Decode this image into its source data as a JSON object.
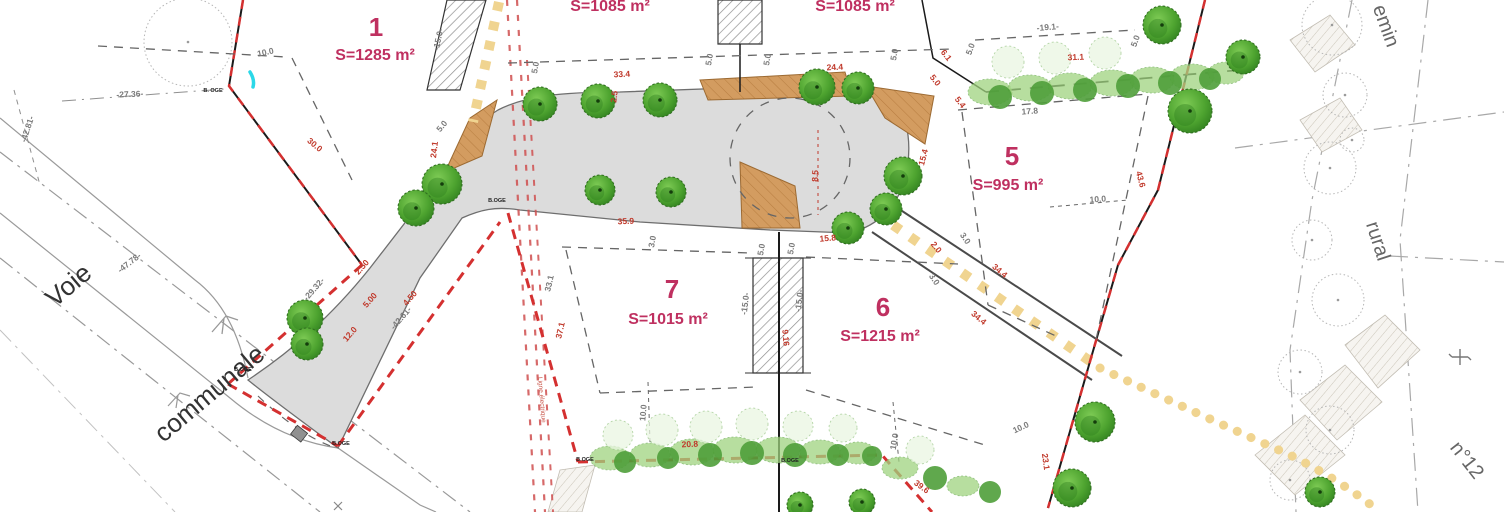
{
  "lots": {
    "lot1": {
      "num": "1",
      "area": "S=1285 m²"
    },
    "lot_top_left": {
      "area": "S=1085 m²"
    },
    "lot_top_right": {
      "area": "S=1085 m²"
    },
    "lot5": {
      "num": "5",
      "area": "S=995 m²"
    },
    "lot6": {
      "num": "6",
      "area": "S=1215 m²"
    },
    "lot7": {
      "num": "7",
      "area": "S=1015 m²"
    }
  },
  "roads": {
    "voie": "Voie",
    "communale": "communale",
    "chemin_partial": "emin",
    "rural": "rural",
    "numero": "n°12"
  },
  "easement_label": "Ligne électrique",
  "colors": {
    "lot_label": "#bf3060",
    "dim_red": "#c0392b",
    "dim_gray": "#7a7a7a",
    "boundary_red": "#d43030",
    "road_fill": "#dcdcdc",
    "island_brown": "#d39c60",
    "hedge_green": "#9fd37f",
    "tree_green": "#4da32f",
    "path_yellow": "#f0d490"
  },
  "map": {
    "survey_marks": [
      {
        "t": "B. OGE",
        "x": 213,
        "y": 92
      },
      {
        "t": "B.OGE",
        "x": 497,
        "y": 202
      },
      {
        "t": "B.OGE",
        "x": 243,
        "y": 371
      },
      {
        "t": "B.OGE",
        "x": 341,
        "y": 445
      },
      {
        "t": "B.OGE",
        "x": 585,
        "y": 461
      },
      {
        "t": "B.OGE",
        "x": 790,
        "y": 462
      }
    ],
    "dim_labels": [
      {
        "t": "-27.36-",
        "x": 130,
        "y": 97,
        "r": -3,
        "c": "g"
      },
      {
        "t": "-47.78-",
        "x": 131,
        "y": 265,
        "r": -38,
        "c": "g"
      },
      {
        "t": "-42.81-",
        "x": 30,
        "y": 130,
        "r": -72,
        "c": "g"
      },
      {
        "t": "-29.32-",
        "x": 316,
        "y": 291,
        "r": -49,
        "c": "g"
      },
      {
        "t": "-42.61-",
        "x": 403,
        "y": 320,
        "r": -49,
        "c": "g"
      },
      {
        "t": "-19.1-",
        "x": 1048,
        "y": 30,
        "r": -5,
        "c": "g"
      },
      {
        "t": "17.8",
        "x": 1030,
        "y": 114,
        "r": -4,
        "c": "g"
      },
      {
        "t": "10.0",
        "x": 266,
        "y": 55,
        "r": -12,
        "c": "g"
      },
      {
        "t": "10.0",
        "x": 1098,
        "y": 202,
        "r": -4,
        "c": "g"
      },
      {
        "t": "10.0",
        "x": 646,
        "y": 413,
        "r": -85,
        "c": "g"
      },
      {
        "t": "10.0",
        "x": 897,
        "y": 442,
        "r": -80,
        "c": "g"
      },
      {
        "t": "10.0",
        "x": 1022,
        "y": 430,
        "r": -25,
        "c": "g"
      },
      {
        "t": "5.0",
        "x": 538,
        "y": 68,
        "r": -80,
        "c": "g"
      },
      {
        "t": "5.0",
        "x": 712,
        "y": 60,
        "r": -80,
        "c": "g"
      },
      {
        "t": "5.0",
        "x": 770,
        "y": 60,
        "r": -80,
        "c": "g"
      },
      {
        "t": "5.0",
        "x": 897,
        "y": 55,
        "r": -80,
        "c": "g"
      },
      {
        "t": "5.0",
        "x": 973,
        "y": 50,
        "r": -70,
        "c": "g"
      },
      {
        "t": "5.0",
        "x": 1138,
        "y": 42,
        "r": -70,
        "c": "g"
      },
      {
        "t": "5.0",
        "x": 444,
        "y": 128,
        "r": -50,
        "c": "g"
      },
      {
        "t": "3.0",
        "x": 655,
        "y": 242,
        "r": -80,
        "c": "g"
      },
      {
        "t": "5.0",
        "x": 764,
        "y": 250,
        "r": -80,
        "c": "g"
      },
      {
        "t": "5.0",
        "x": 794,
        "y": 249,
        "r": -80,
        "c": "g"
      },
      {
        "t": "-15.0-",
        "x": 441,
        "y": 40,
        "r": -78,
        "c": "g"
      },
      {
        "t": "-15.0-",
        "x": 748,
        "y": 304,
        "r": -83,
        "c": "g"
      },
      {
        "t": "-15.0-",
        "x": 802,
        "y": 301,
        "r": -83,
        "c": "g"
      },
      {
        "t": "3.0",
        "x": 963,
        "y": 240,
        "r": 55,
        "c": "g"
      },
      {
        "t": "3.0",
        "x": 932,
        "y": 281,
        "r": 55,
        "c": "g"
      },
      {
        "t": "33.1",
        "x": 552,
        "y": 284,
        "r": -77,
        "c": "g"
      },
      {
        "t": "30.0",
        "x": 313,
        "y": 147,
        "r": 40,
        "c": "r"
      },
      {
        "t": "24.1",
        "x": 437,
        "y": 150,
        "r": -83,
        "c": "r"
      },
      {
        "t": "33.4",
        "x": 622,
        "y": 77,
        "r": -3,
        "c": "r"
      },
      {
        "t": "2.5",
        "x": 617,
        "y": 97,
        "r": -83,
        "c": "r"
      },
      {
        "t": "24.4",
        "x": 835,
        "y": 70,
        "r": -3,
        "c": "r"
      },
      {
        "t": "35.9",
        "x": 626,
        "y": 224,
        "r": -3,
        "c": "r"
      },
      {
        "t": "8.5",
        "x": 818,
        "y": 176,
        "r": -88,
        "c": "r"
      },
      {
        "t": "15.8",
        "x": 828,
        "y": 241,
        "r": -5,
        "c": "r"
      },
      {
        "t": "15.4",
        "x": 926,
        "y": 158,
        "r": -75,
        "c": "r"
      },
      {
        "t": "6.1",
        "x": 944,
        "y": 57,
        "r": 52,
        "c": "r"
      },
      {
        "t": "5.0",
        "x": 933,
        "y": 82,
        "r": 52,
        "c": "r"
      },
      {
        "t": "5.4",
        "x": 958,
        "y": 104,
        "r": 52,
        "c": "r"
      },
      {
        "t": "2.0",
        "x": 934,
        "y": 249,
        "r": 52,
        "c": "r"
      },
      {
        "t": "31.1",
        "x": 1076,
        "y": 60,
        "r": -3,
        "c": "r"
      },
      {
        "t": "43.6",
        "x": 1138,
        "y": 180,
        "r": 75,
        "c": "r"
      },
      {
        "t": "34.4",
        "x": 998,
        "y": 273,
        "r": 40,
        "c": "r"
      },
      {
        "t": "34.4",
        "x": 977,
        "y": 320,
        "r": 40,
        "c": "r"
      },
      {
        "t": "23.1",
        "x": 1043,
        "y": 462,
        "r": 82,
        "c": "r"
      },
      {
        "t": "37.1",
        "x": 563,
        "y": 331,
        "r": -77,
        "c": "r"
      },
      {
        "t": "12.0",
        "x": 352,
        "y": 336,
        "r": -49,
        "c": "r"
      },
      {
        "t": "2.50",
        "x": 364,
        "y": 269,
        "r": -49,
        "c": "r"
      },
      {
        "t": "5.00",
        "x": 372,
        "y": 302,
        "r": -49,
        "c": "r"
      },
      {
        "t": "4.50",
        "x": 412,
        "y": 300,
        "r": -49,
        "c": "r"
      },
      {
        "t": "20.8",
        "x": 690,
        "y": 447,
        "r": -3,
        "c": "r"
      },
      {
        "t": "39.6",
        "x": 920,
        "y": 489,
        "r": 36,
        "c": "r"
      },
      {
        "t": "9.16",
        "x": 783,
        "y": 338,
        "r": 85,
        "c": "r"
      }
    ],
    "trees": [
      [
        540,
        104,
        17
      ],
      [
        598,
        101,
        17
      ],
      [
        660,
        100,
        17
      ],
      [
        817,
        87,
        18
      ],
      [
        858,
        88,
        16
      ],
      [
        903,
        176,
        19
      ],
      [
        886,
        209,
        16
      ],
      [
        848,
        228,
        16
      ],
      [
        442,
        184,
        20
      ],
      [
        416,
        208,
        18
      ],
      [
        600,
        190,
        15
      ],
      [
        671,
        192,
        15
      ],
      [
        305,
        318,
        18
      ],
      [
        307,
        344,
        16
      ],
      [
        1162,
        25,
        19
      ],
      [
        1243,
        57,
        17
      ],
      [
        1190,
        111,
        22
      ],
      [
        1095,
        422,
        20
      ],
      [
        1072,
        488,
        19
      ],
      [
        1320,
        492,
        15
      ],
      [
        800,
        505,
        13
      ],
      [
        862,
        502,
        13
      ]
    ],
    "hedge_light": [
      [
        990,
        92,
        22,
        13
      ],
      [
        1030,
        88,
        22,
        13
      ],
      [
        1070,
        86,
        22,
        13
      ],
      [
        1112,
        83,
        22,
        13
      ],
      [
        1152,
        80,
        22,
        13
      ],
      [
        1192,
        77,
        22,
        13
      ],
      [
        1226,
        73,
        18,
        11
      ],
      [
        610,
        458,
        20,
        12
      ],
      [
        650,
        455,
        20,
        12
      ],
      [
        692,
        452,
        22,
        13
      ],
      [
        735,
        450,
        22,
        13
      ],
      [
        778,
        450,
        22,
        13
      ],
      [
        820,
        452,
        20,
        12
      ],
      [
        858,
        453,
        18,
        11
      ],
      [
        900,
        468,
        18,
        11
      ],
      [
        963,
        486,
        16,
        10
      ]
    ],
    "hedge_dark": [
      [
        1000,
        97,
        12
      ],
      [
        1042,
        93,
        12
      ],
      [
        1085,
        90,
        12
      ],
      [
        1128,
        86,
        12
      ],
      [
        1170,
        83,
        12
      ],
      [
        1210,
        79,
        11
      ],
      [
        625,
        462,
        11
      ],
      [
        668,
        458,
        11
      ],
      [
        710,
        455,
        12
      ],
      [
        752,
        453,
        12
      ],
      [
        795,
        455,
        12
      ],
      [
        838,
        455,
        11
      ],
      [
        872,
        456,
        10
      ],
      [
        935,
        478,
        12
      ],
      [
        990,
        492,
        11
      ]
    ],
    "hedge_pale": [
      [
        1008,
        62,
        16
      ],
      [
        1055,
        58,
        16
      ],
      [
        1105,
        53,
        16
      ],
      [
        618,
        435,
        15
      ],
      [
        662,
        430,
        16
      ],
      [
        706,
        427,
        16
      ],
      [
        752,
        424,
        16
      ],
      [
        798,
        426,
        15
      ],
      [
        843,
        428,
        14
      ],
      [
        920,
        450,
        14
      ]
    ],
    "sketch_trees": [
      [
        188,
        42,
        44
      ],
      [
        1332,
        25,
        30
      ],
      [
        1345,
        95,
        22
      ],
      [
        1330,
        168,
        26
      ],
      [
        1312,
        240,
        20
      ],
      [
        1338,
        300,
        26
      ],
      [
        1300,
        372,
        22
      ],
      [
        1330,
        430,
        24
      ],
      [
        1290,
        480,
        20
      ],
      [
        1352,
        140,
        12
      ]
    ]
  }
}
